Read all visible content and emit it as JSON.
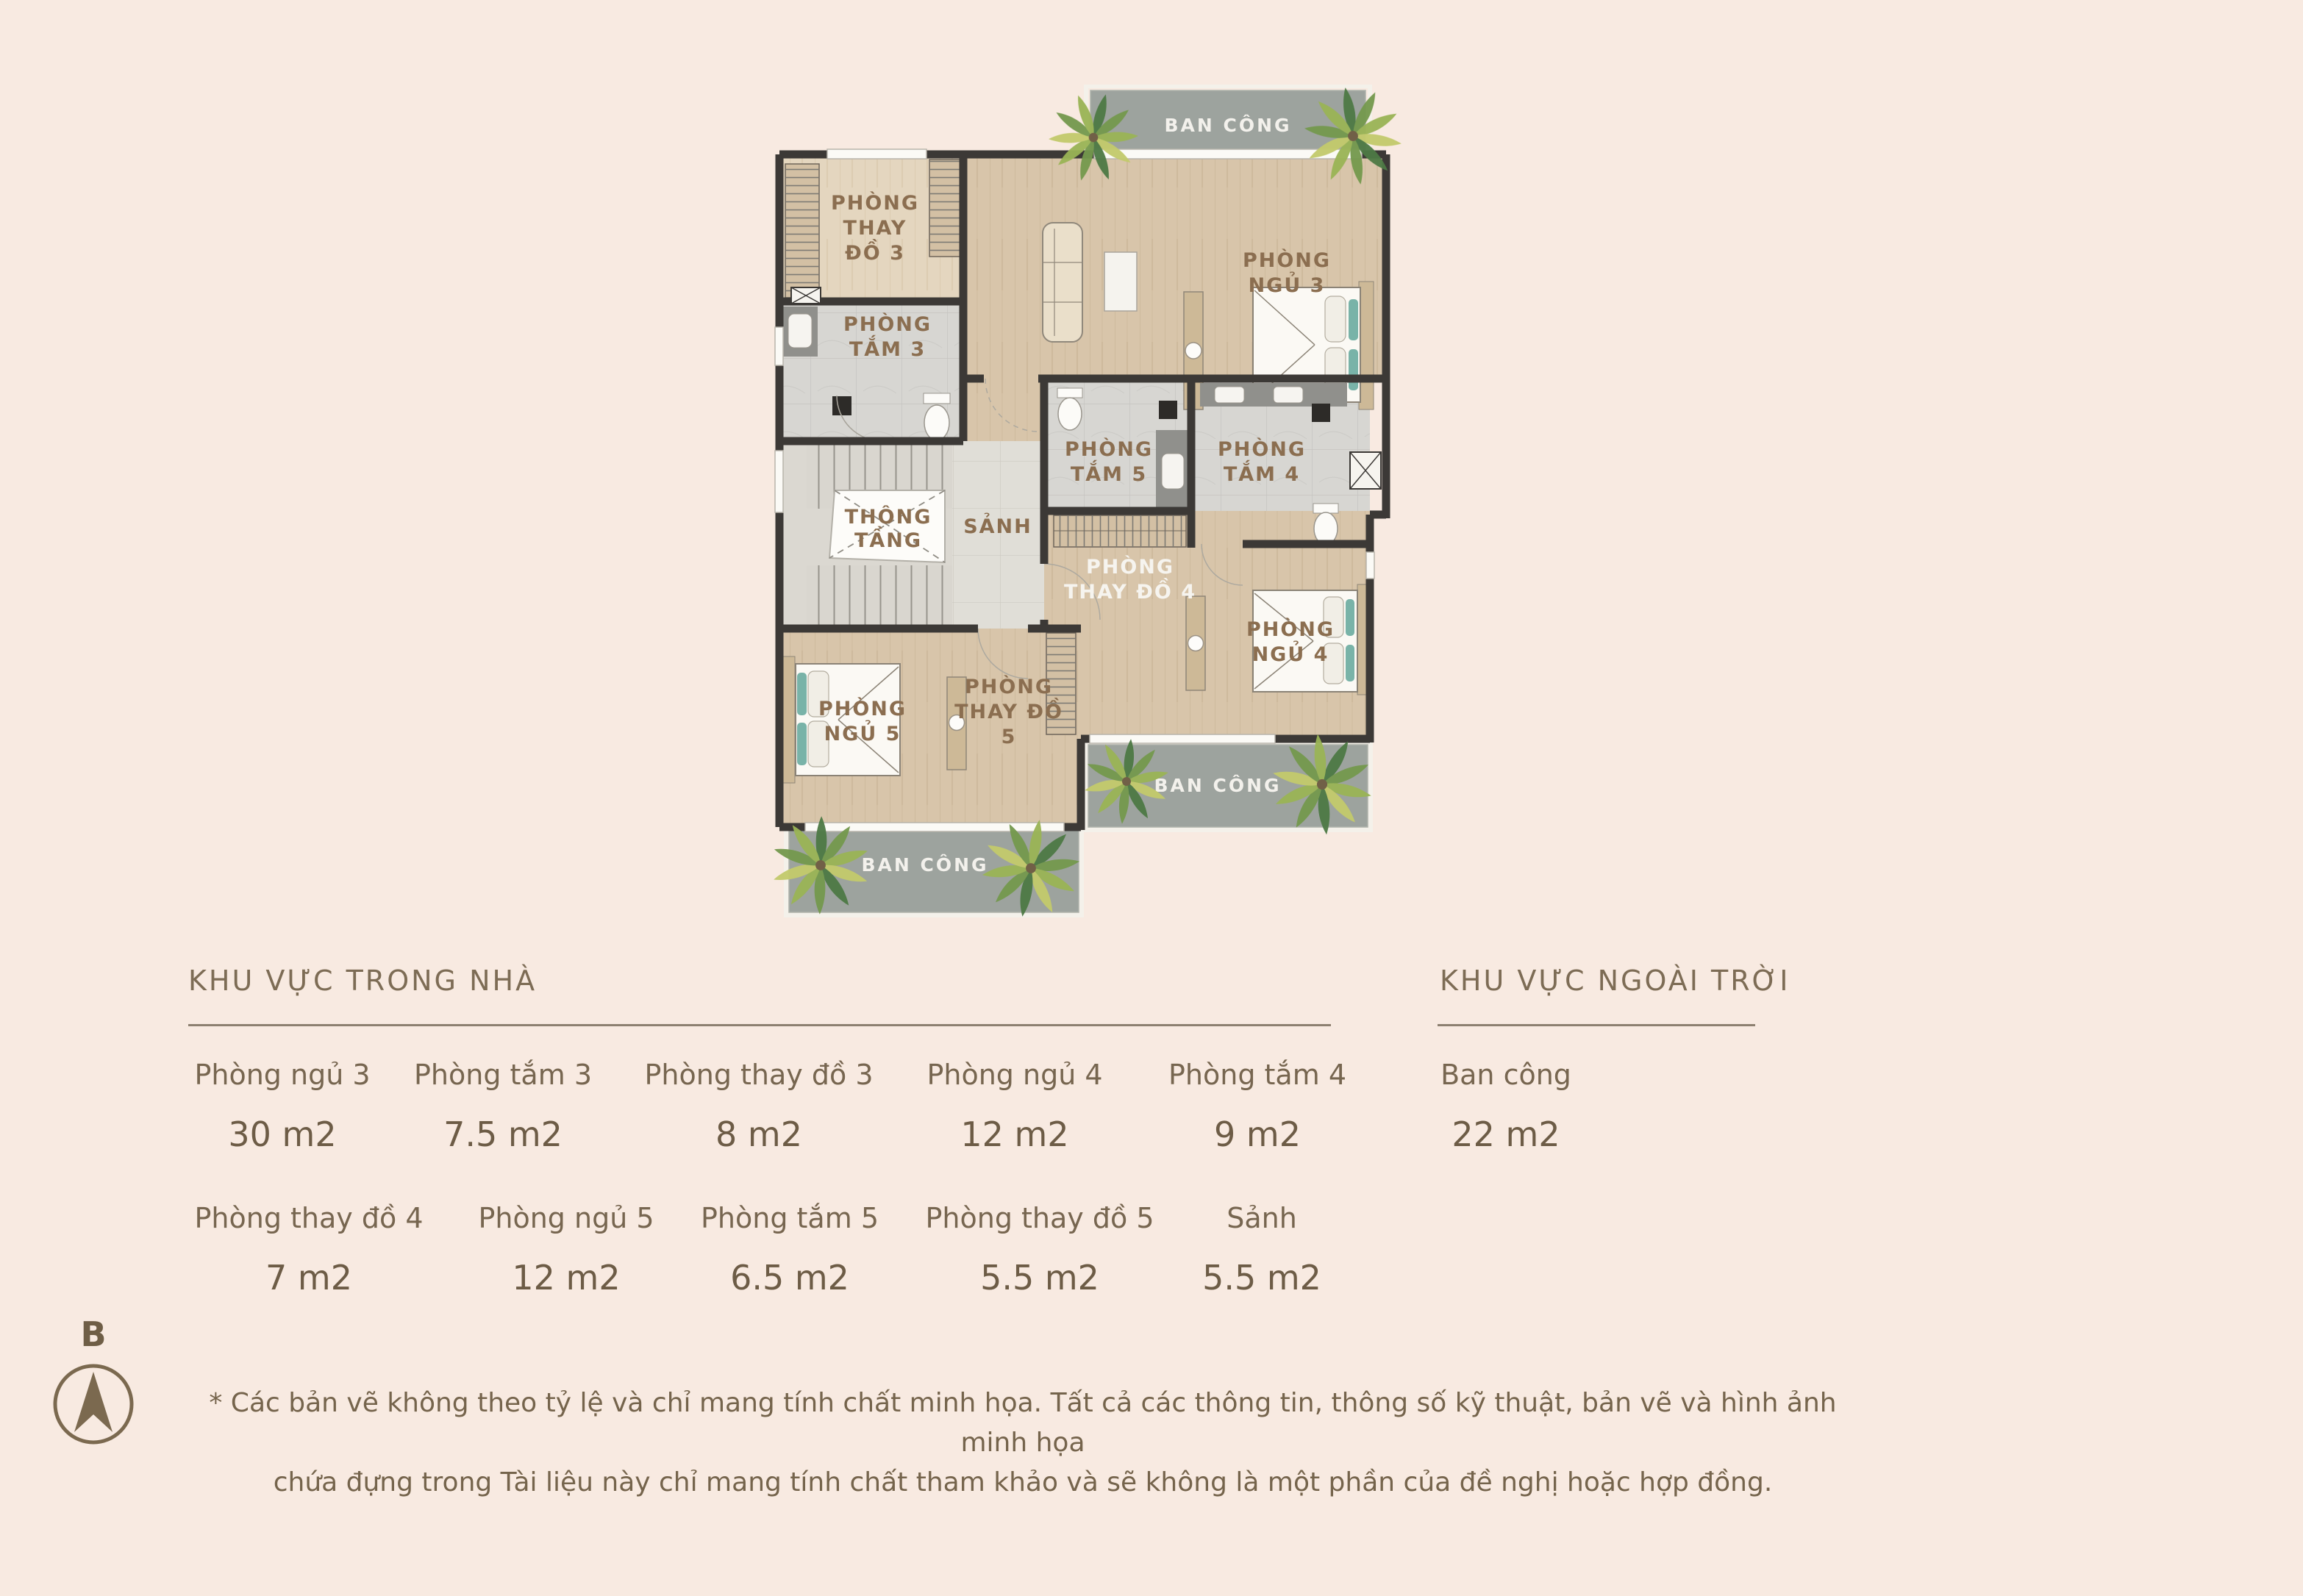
{
  "page": {
    "background": "#f8eae1"
  },
  "plan": {
    "labels": {
      "balcony_top": "BAN CÔNG",
      "balcony_bottom_right": "BAN CÔNG",
      "balcony_bottom_left": "BAN CÔNG",
      "thay_do_3": [
        "PHÒNG",
        "THAY",
        "ĐỒ 3"
      ],
      "tam_3": [
        "PHÒNG",
        "TẮM 3"
      ],
      "ngu_3": [
        "PHÒNG",
        "NGỦ 3"
      ],
      "tam_5": [
        "PHÒNG",
        "TẮM 5"
      ],
      "tam_4": [
        "PHÒNG",
        "TẮM 4"
      ],
      "thong_tang": [
        "THÔNG",
        "TẦNG"
      ],
      "sanh": "SẢNH",
      "thay_do_4": [
        "PHÒNG",
        "THAY ĐỒ 4"
      ],
      "ngu_4": [
        "PHÒNG",
        "NGỦ 4"
      ],
      "ngu_5": [
        "PHÒNG",
        "NGỦ 5"
      ],
      "thay_do_5": [
        "PHÒNG",
        "THAY ĐỒ",
        "5"
      ]
    },
    "colors": {
      "wall": "#3c3936",
      "wood_floor": "#d8c5aa",
      "wood_floor_light": "#e4d6bf",
      "tile": "#d7d6d2",
      "balcony_gray": "#9da39e",
      "label_brown": "#8b6e50",
      "label_white": "#f6f4ef",
      "pillow_teal": "#79b3a8",
      "palm_green": "#74994e"
    }
  },
  "legend": {
    "indoor": {
      "title": "KHU VỰC TRONG NHÀ",
      "items": [
        {
          "name": "Phòng ngủ 3",
          "area": "30 m2"
        },
        {
          "name": "Phòng tắm 3",
          "area": "7.5 m2"
        },
        {
          "name": "Phòng thay đồ 3",
          "area": "8 m2"
        },
        {
          "name": "Phòng ngủ 4",
          "area": "12 m2"
        },
        {
          "name": "Phòng tắm 4",
          "area": "9 m2"
        },
        {
          "name": "Phòng thay đồ 4",
          "area": "7 m2"
        },
        {
          "name": "Phòng ngủ 5",
          "area": "12 m2"
        },
        {
          "name": "Phòng tắm 5",
          "area": "6.5 m2"
        },
        {
          "name": "Phòng thay đồ 5",
          "area": "5.5 m2"
        },
        {
          "name": "Sảnh",
          "area": "5.5 m2"
        }
      ]
    },
    "outdoor": {
      "title": "KHU VỰC NGOÀI TRỜI",
      "items": [
        {
          "name": "Ban công",
          "area": "22 m2"
        }
      ]
    }
  },
  "compass": {
    "label": "B"
  },
  "disclaimer": {
    "line1": "* Các bản vẽ không theo tỷ lệ và chỉ mang tính chất minh họa. Tất cả các thông tin, thông số kỹ thuật, bản vẽ và hình ảnh minh họa",
    "line2": "chứa đựng trong Tài liệu này chỉ mang tính chất tham khảo và sẽ không là một phần của đề nghị hoặc hợp đồng."
  }
}
